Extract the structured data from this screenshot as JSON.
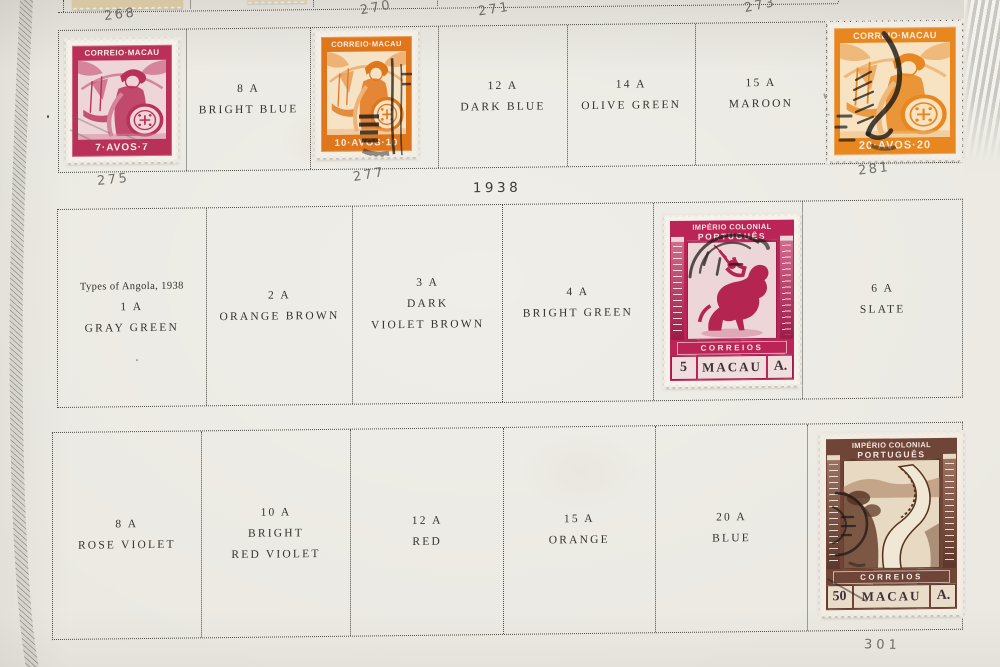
{
  "year_heading": "1938",
  "annotations": [
    "268",
    "270",
    "271",
    "273",
    "275",
    "277",
    "281",
    "301"
  ],
  "rows": {
    "row1": {
      "cells": [
        {
          "kind": "stamp",
          "stamp": "avos7"
        },
        {
          "lines": [
            "8 A",
            "BRIGHT BLUE"
          ]
        },
        {
          "kind": "stamp",
          "stamp": "avos10"
        },
        {
          "lines": [
            "12 A",
            "DARK BLUE"
          ]
        },
        {
          "lines": [
            "14 A",
            "OLIVE GREEN"
          ]
        },
        {
          "lines": [
            "15 A",
            "MAROON"
          ]
        },
        {
          "kind": "stamp",
          "stamp": "avos20"
        }
      ]
    },
    "row2": {
      "cells": [
        {
          "lines": [
            "Types of Angola, 1938",
            "1 A",
            "GRAY GREEN"
          ]
        },
        {
          "lines": [
            "2 A",
            "ORANGE BROWN"
          ]
        },
        {
          "lines": [
            "3 A",
            "DARK",
            "VIOLET BROWN"
          ]
        },
        {
          "lines": [
            "4 A",
            "BRIGHT GREEN"
          ]
        },
        {
          "kind": "stamp",
          "stamp": "a5"
        },
        {
          "lines": [
            "6 A",
            "SLATE"
          ]
        }
      ]
    },
    "row3": {
      "cells": [
        {
          "lines": [
            "8 A",
            "ROSE VIOLET"
          ]
        },
        {
          "lines": [
            "10 A",
            "BRIGHT",
            "RED VIOLET"
          ]
        },
        {
          "lines": [
            "12 A",
            "RED"
          ]
        },
        {
          "lines": [
            "15 A",
            "ORANGE"
          ]
        },
        {
          "lines": [
            "20 A",
            "BLUE"
          ]
        },
        {
          "kind": "stamp",
          "stamp": "a50"
        }
      ]
    }
  },
  "stamps": {
    "avos7": {
      "top_text": "CORREIO·MACAU",
      "bottom_text": "7·AVOS·7",
      "color": "#b93058"
    },
    "avos10": {
      "top_text": "CORREIO·MACAU",
      "bottom_text": "10·AVOS·10",
      "color": "#e0761c"
    },
    "avos20": {
      "top_text": "CORREIO·MACAU",
      "bottom_text": "20·AVOS·20",
      "color": "#e8871f"
    },
    "a5": {
      "title1": "IMPÉRIO COLONIAL",
      "title2": "PORTUGUÊS",
      "band": "CORREIOS",
      "value": "5",
      "country": "MACAU",
      "currency": "A.",
      "color": "#bb2457"
    },
    "a50": {
      "title1": "IMPÉRIO COLONIAL",
      "title2": "PORTUGUÊS",
      "subtitle": "FOMENTO",
      "band": "CORREIOS",
      "value": "50",
      "country": "MACAU",
      "currency": "A.",
      "color": "#6f4537"
    }
  },
  "colors": {
    "paper": "#ebe9e2",
    "grid_dots": "#4c4b44",
    "label_ink": "#34332d",
    "pencil": "#5f5d56"
  }
}
